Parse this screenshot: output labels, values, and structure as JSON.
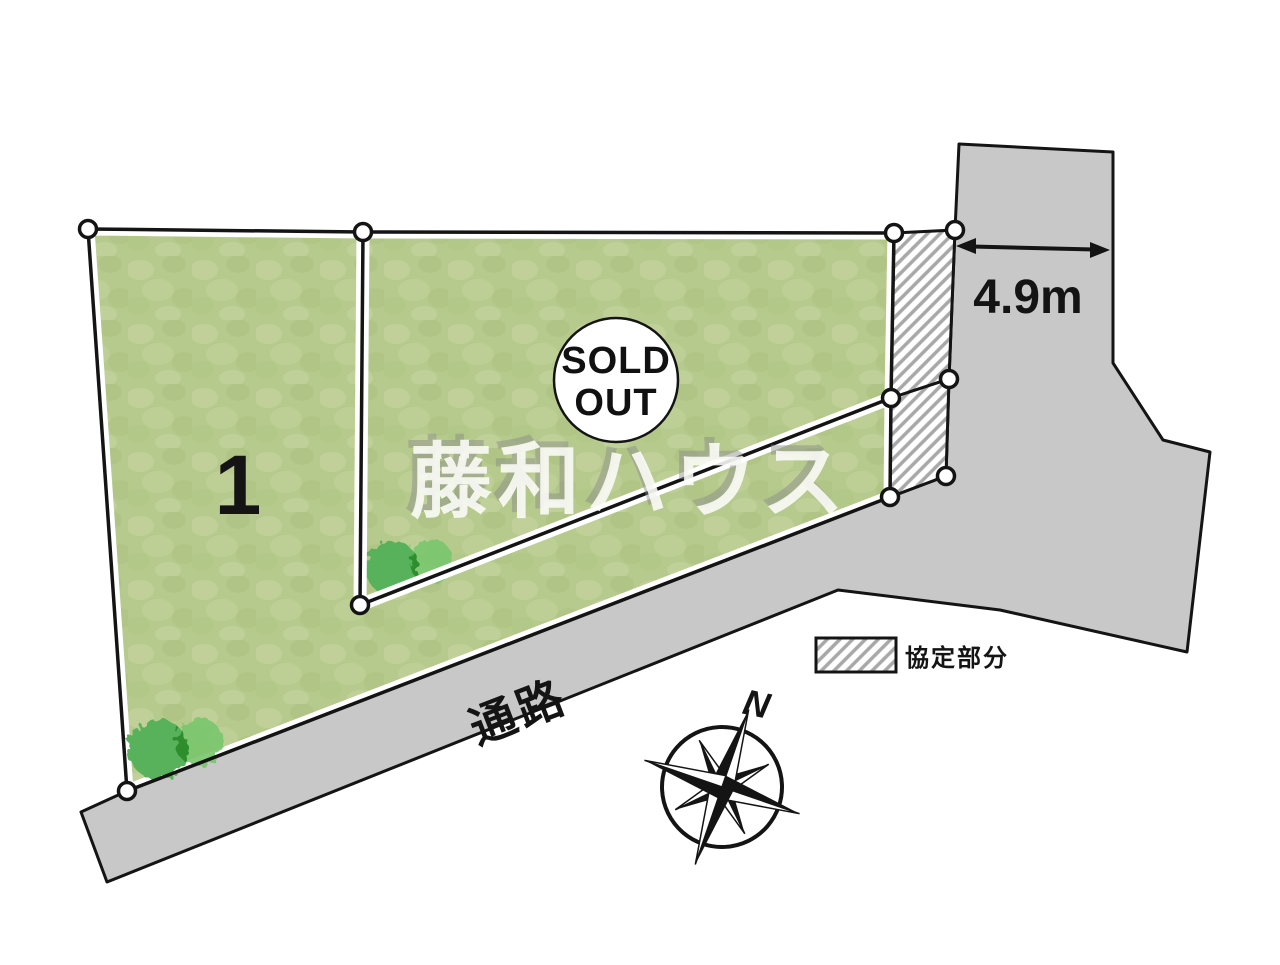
{
  "plan_labels": {
    "lot_number": "1",
    "sold_out_line1": "SOLD",
    "sold_out_line2": "OUT",
    "frontage_dimension": "4.9m",
    "road": "通路",
    "legend_agreement_area": "協定部分",
    "compass_north": "N",
    "watermark": "藤和ハウス"
  },
  "colors": {
    "lot_green": "#b7ca8d",
    "lot_green_light": "#c6d5a0",
    "lot_green_dark": "#a9c07e",
    "road_gray": "#c8c8c8",
    "outline": "#141414",
    "hatch_line": "#a8a8a8",
    "tree_dark": "#58b25c",
    "tree_light": "#79c66d",
    "watermark_fill": "#fdfdfa",
    "watermark_shadow": "#8a8a8a"
  }
}
